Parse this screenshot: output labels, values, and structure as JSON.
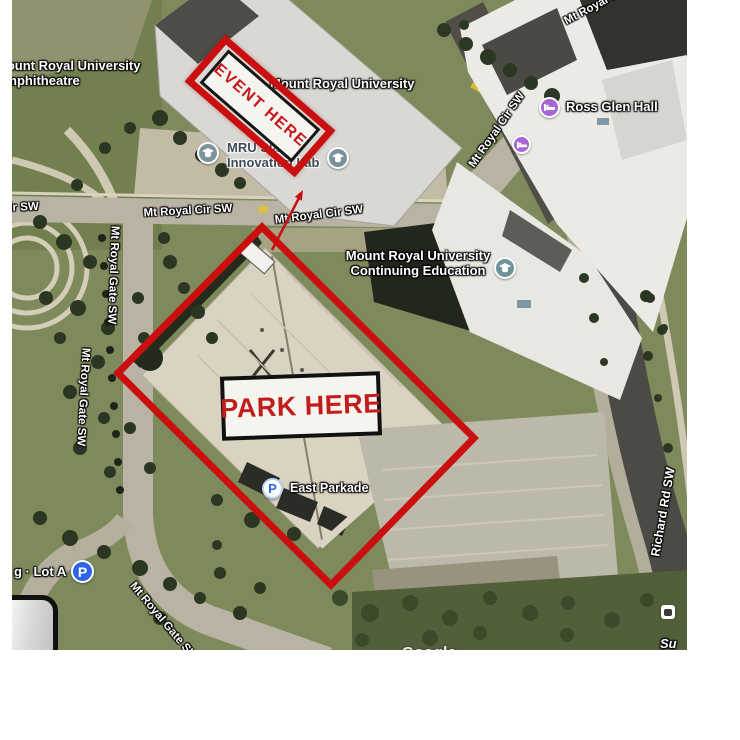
{
  "annotations": {
    "event": "EVENT HERE",
    "park": "PARK HERE"
  },
  "streets": {
    "mt_royal_cir_sw": "Mt Royal Cir SW",
    "mt_royal_gate_sw": "Mt Royal Gate SW",
    "richard_rd_sw": "Richard Rd SW"
  },
  "pois": {
    "amphitheatre": {
      "line1": "Mount Royal University",
      "line2": "Amphitheatre"
    },
    "university": "Mount Royal University",
    "slate": {
      "line1": "MRU Slate",
      "line2": "Innovation Lab"
    },
    "ross_glen_hall": "Ross Glen Hall",
    "continuing_education": {
      "line1": "Mount Royal University",
      "line2": "Continuing Education"
    },
    "east_parkade": "East Parkade",
    "lot_a": "g · Lot A",
    "partial_neighbourhood": "Su"
  },
  "icons": {
    "parking_letter": "P"
  },
  "watermark": "Google",
  "colors": {
    "annotation_red": "#c90f0f",
    "park_text_red": "#c21d1d",
    "parking_blue": "#2f63e8",
    "lodging_purple": "#a765d6",
    "education_gray_blue": "#7b919c",
    "education_teal": "#6f9199"
  }
}
